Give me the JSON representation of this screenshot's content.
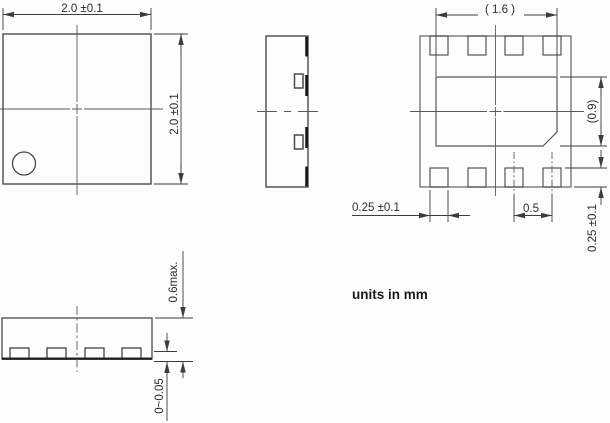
{
  "note": "units in mm",
  "views": {
    "top_view": {
      "width": "2.0 ±0.1",
      "height": "2.0 ±0.1"
    },
    "bottom_view": {
      "exposed_pad_width": "( 1.6 )",
      "exposed_pad_height": "(0.9)",
      "terminal_width": "0.25 ±0.1",
      "terminal_pitch": "0.5",
      "terminal_length": "0.25 ±0.1"
    },
    "front_view": {
      "package_height": "0.6max.",
      "standoff": "0~0.05"
    }
  }
}
